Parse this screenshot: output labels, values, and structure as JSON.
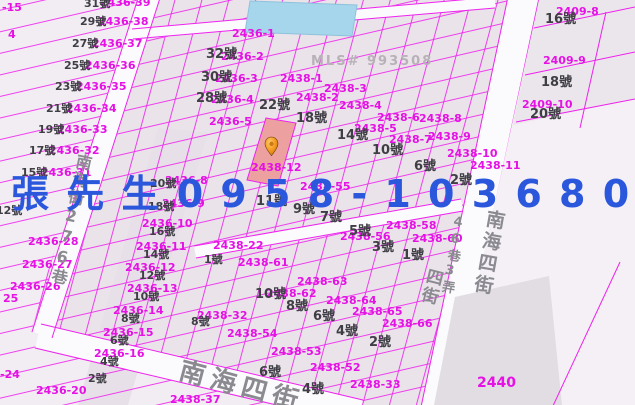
{
  "map": {
    "type": "cadastral-parcel-map",
    "colors": {
      "background": "#f2ecf3",
      "parcel_line": "#ee22ee",
      "street_fill": "#fbfafc",
      "highlight_parcel_fill": "#eda0a0",
      "building_fill": "#a6d6eb",
      "pin_orange": "#f59a1e",
      "watermark_blue": "#2b57dc",
      "parcel_label": "#e511e5",
      "address_label": "#3e3e44",
      "street_label": "#8a8a90"
    },
    "highlighted_parcel": "2438-12",
    "labels": {
      "parcels": [
        {
          "t": "2436-39",
          "x": 100,
          "y": -3
        },
        {
          "t": "2436-38",
          "x": 98,
          "y": 16
        },
        {
          "t": "2436-37",
          "x": 92,
          "y": 38
        },
        {
          "t": "2436-36",
          "x": 85,
          "y": 60
        },
        {
          "t": "2436-35",
          "x": 76,
          "y": 81
        },
        {
          "t": "2436-34",
          "x": 66,
          "y": 103
        },
        {
          "t": "2436-33",
          "x": 57,
          "y": 124
        },
        {
          "t": "2436-32",
          "x": 49,
          "y": 145
        },
        {
          "t": "2436-31",
          "x": 41,
          "y": 167
        },
        {
          "t": "-15",
          "x": 2,
          "y": 2
        },
        {
          "t": "4",
          "x": 8,
          "y": 29
        },
        {
          "t": "2436-28",
          "x": 28,
          "y": 236
        },
        {
          "t": "2436-27",
          "x": 22,
          "y": 259
        },
        {
          "t": "2436-26",
          "x": 10,
          "y": 281
        },
        {
          "t": "25",
          "x": 3,
          "y": 293
        },
        {
          "t": "-24",
          "x": 0,
          "y": 369
        },
        {
          "t": "2436-20",
          "x": 36,
          "y": 385
        },
        {
          "t": "2438-37",
          "x": 170,
          "y": 394
        },
        {
          "t": "2436-1",
          "x": 232,
          "y": 28
        },
        {
          "t": "2436-2",
          "x": 221,
          "y": 51
        },
        {
          "t": "2436-3",
          "x": 215,
          "y": 73
        },
        {
          "t": "2436-4",
          "x": 211,
          "y": 94
        },
        {
          "t": "2436-5",
          "x": 209,
          "y": 116
        },
        {
          "t": "2438-1",
          "x": 280,
          "y": 73
        },
        {
          "t": "2438-2",
          "x": 296,
          "y": 92
        },
        {
          "t": "2438-3",
          "x": 324,
          "y": 83
        },
        {
          "t": "2438-4",
          "x": 339,
          "y": 100
        },
        {
          "t": "2438-5",
          "x": 354,
          "y": 123
        },
        {
          "t": "2438-6",
          "x": 377,
          "y": 112
        },
        {
          "t": "2438-7",
          "x": 389,
          "y": 134
        },
        {
          "t": "2438-8",
          "x": 419,
          "y": 113
        },
        {
          "t": "2438-9",
          "x": 428,
          "y": 131
        },
        {
          "t": "2438-10",
          "x": 447,
          "y": 148
        },
        {
          "t": "2438-11",
          "x": 470,
          "y": 160
        },
        {
          "t": "2438-12",
          "x": 251,
          "y": 162
        },
        {
          "t": "2409-8",
          "x": 556,
          "y": 6
        },
        {
          "t": "2409-9",
          "x": 543,
          "y": 55
        },
        {
          "t": "2409-10",
          "x": 522,
          "y": 99
        },
        {
          "t": "2438-55",
          "x": 300,
          "y": 181
        },
        {
          "t": "2438-56",
          "x": 340,
          "y": 231
        },
        {
          "t": "2438-58",
          "x": 386,
          "y": 220
        },
        {
          "t": "2438-60",
          "x": 412,
          "y": 233
        },
        {
          "t": "2438-22",
          "x": 213,
          "y": 240
        },
        {
          "t": "2438-61",
          "x": 238,
          "y": 257
        },
        {
          "t": "2438-62",
          "x": 266,
          "y": 288
        },
        {
          "t": "2438-63",
          "x": 297,
          "y": 276
        },
        {
          "t": "2438-64",
          "x": 326,
          "y": 295
        },
        {
          "t": "2438-65",
          "x": 352,
          "y": 306
        },
        {
          "t": "2438-66",
          "x": 382,
          "y": 318
        },
        {
          "t": "2438-54",
          "x": 227,
          "y": 328
        },
        {
          "t": "2438-53",
          "x": 271,
          "y": 346
        },
        {
          "t": "2438-52",
          "x": 310,
          "y": 362
        },
        {
          "t": "2438-33",
          "x": 350,
          "y": 379
        },
        {
          "t": "2438-32",
          "x": 197,
          "y": 310
        },
        {
          "t": "2436-8",
          "x": 165,
          "y": 175
        },
        {
          "t": "2436-9",
          "x": 162,
          "y": 198
        },
        {
          "t": "2436-10",
          "x": 142,
          "y": 218
        },
        {
          "t": "2436-11",
          "x": 136,
          "y": 241
        },
        {
          "t": "2436-12",
          "x": 125,
          "y": 262
        },
        {
          "t": "2436-13",
          "x": 127,
          "y": 283
        },
        {
          "t": "2436-14",
          "x": 113,
          "y": 305
        },
        {
          "t": "2436-15",
          "x": 103,
          "y": 327
        },
        {
          "t": "2436-16",
          "x": 94,
          "y": 348
        },
        {
          "t": "2440",
          "x": 477,
          "y": 376,
          "lg": true
        }
      ],
      "addresses": [
        {
          "t": "31號",
          "x": 84,
          "y": -2
        },
        {
          "t": "29號",
          "x": 80,
          "y": 16
        },
        {
          "t": "27號",
          "x": 72,
          "y": 38
        },
        {
          "t": "25號",
          "x": 64,
          "y": 60
        },
        {
          "t": "23號",
          "x": 55,
          "y": 81
        },
        {
          "t": "21號",
          "x": 46,
          "y": 103
        },
        {
          "t": "19號",
          "x": 38,
          "y": 124
        },
        {
          "t": "17號",
          "x": 29,
          "y": 145
        },
        {
          "t": "15號",
          "x": 21,
          "y": 167
        },
        {
          "t": "12號",
          "x": -4,
          "y": 205
        },
        {
          "t": "32號",
          "x": 206,
          "y": 48,
          "lg": true
        },
        {
          "t": "30號",
          "x": 201,
          "y": 71,
          "lg": true
        },
        {
          "t": "28號",
          "x": 196,
          "y": 92,
          "lg": true
        },
        {
          "t": "22號",
          "x": 259,
          "y": 99,
          "lg": true
        },
        {
          "t": "18號",
          "x": 296,
          "y": 112,
          "lg": true
        },
        {
          "t": "14號",
          "x": 337,
          "y": 129,
          "lg": true
        },
        {
          "t": "10號",
          "x": 372,
          "y": 144,
          "lg": true
        },
        {
          "t": "6號",
          "x": 414,
          "y": 160,
          "lg": true
        },
        {
          "t": "2號",
          "x": 450,
          "y": 174,
          "lg": true
        },
        {
          "t": "16號",
          "x": 545,
          "y": 13,
          "lg": true
        },
        {
          "t": "18號",
          "x": 541,
          "y": 76,
          "lg": true
        },
        {
          "t": "20號",
          "x": 530,
          "y": 108,
          "lg": true
        },
        {
          "t": "20號",
          "x": 150,
          "y": 178
        },
        {
          "t": "18號",
          "x": 148,
          "y": 201
        },
        {
          "t": "16號",
          "x": 149,
          "y": 226
        },
        {
          "t": "14號",
          "x": 143,
          "y": 249
        },
        {
          "t": "12號",
          "x": 139,
          "y": 270
        },
        {
          "t": "10號",
          "x": 133,
          "y": 291
        },
        {
          "t": "8號",
          "x": 121,
          "y": 313
        },
        {
          "t": "6號",
          "x": 110,
          "y": 335
        },
        {
          "t": "4號",
          "x": 100,
          "y": 356
        },
        {
          "t": "2號",
          "x": 88,
          "y": 373
        },
        {
          "t": "8號",
          "x": 191,
          "y": 316
        },
        {
          "t": "11號",
          "x": 256,
          "y": 195,
          "lg": true
        },
        {
          "t": "9號",
          "x": 293,
          "y": 203,
          "lg": true
        },
        {
          "t": "7號",
          "x": 320,
          "y": 211,
          "lg": true
        },
        {
          "t": "5號",
          "x": 349,
          "y": 225,
          "lg": true
        },
        {
          "t": "3號",
          "x": 372,
          "y": 241,
          "lg": true
        },
        {
          "t": "1號",
          "x": 402,
          "y": 249,
          "lg": true
        },
        {
          "t": "1號",
          "x": 204,
          "y": 254
        },
        {
          "t": "10號",
          "x": 255,
          "y": 288,
          "lg": true
        },
        {
          "t": "8號",
          "x": 286,
          "y": 300,
          "lg": true
        },
        {
          "t": "6號",
          "x": 313,
          "y": 310,
          "lg": true
        },
        {
          "t": "4號",
          "x": 336,
          "y": 325,
          "lg": true
        },
        {
          "t": "2號",
          "x": 369,
          "y": 336,
          "lg": true
        },
        {
          "t": "6號",
          "x": 259,
          "y": 366,
          "lg": true
        },
        {
          "t": "4號",
          "x": 302,
          "y": 383,
          "lg": true
        }
      ],
      "streets": [
        {
          "t": "南海街276巷",
          "x": 76,
          "y": 152,
          "vertical": true,
          "rot": 12,
          "size": 16,
          "ls": 2
        },
        {
          "t": "南海四街",
          "x": 486,
          "y": 208,
          "vertical": true,
          "rot": 10,
          "size": 19,
          "ls": 3
        },
        {
          "t": "46巷3弄",
          "x": 453,
          "y": 214,
          "vertical": true,
          "rot": 10,
          "size": 13,
          "ls": 2
        },
        {
          "t": "四街",
          "x": 426,
          "y": 266,
          "vertical": true,
          "rot": 14,
          "size": 17,
          "ls": 2
        },
        {
          "t": "南海四街",
          "x": 183,
          "y": 358,
          "rot": 15,
          "size": 26,
          "ls": 6
        }
      ]
    }
  },
  "watermarks": {
    "phone": {
      "text": "張 先 生 0 9 5 8 - 1 0 3 6 8 0",
      "color": "#2b57dc"
    },
    "mls": {
      "text": "MLS# 993508",
      "color": "#b8b1b8"
    }
  }
}
